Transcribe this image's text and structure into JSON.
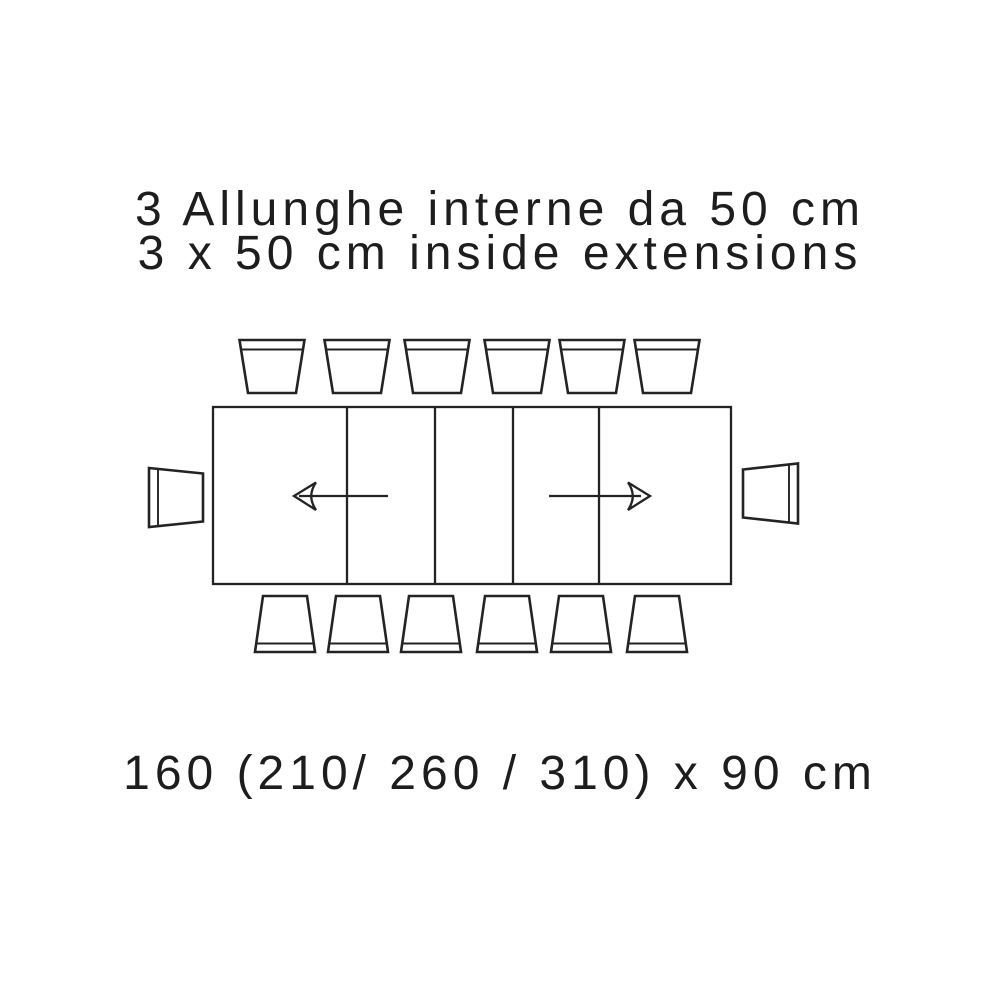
{
  "page": {
    "background_color": "#ffffff",
    "line_color": "#232323",
    "text_color": "#1d1d1d"
  },
  "title": {
    "line1": "3 Allunghe interne da 50 cm",
    "line2": "3 x 50 cm inside extensions"
  },
  "dimension_label": "160 (210/ 260 / 310) x 90 cm",
  "diagram": {
    "table": {
      "closed_length_cm": 160,
      "extended_lengths_cm": [
        210,
        260,
        310
      ],
      "depth_cm": 90,
      "extension_count": 3,
      "extension_size_cm": 50
    },
    "chairs": {
      "top": 6,
      "bottom": 6,
      "left": 1,
      "right": 1
    }
  }
}
